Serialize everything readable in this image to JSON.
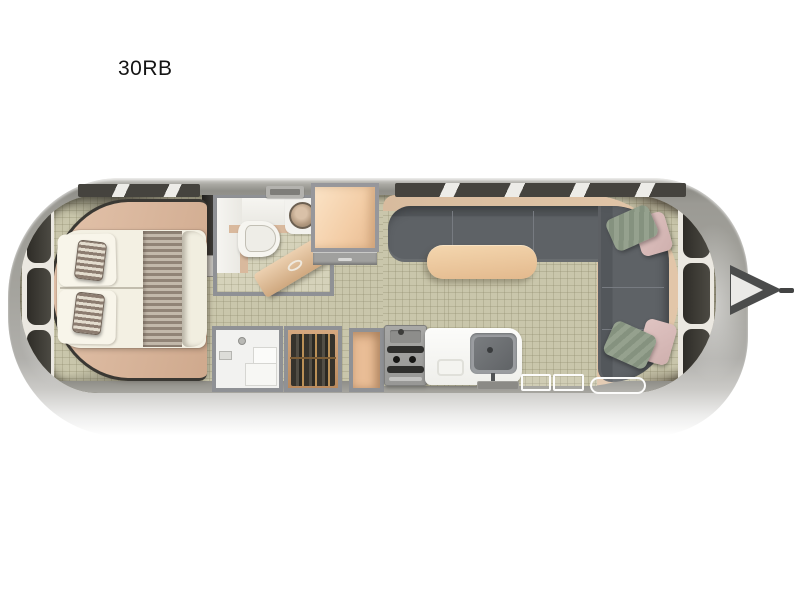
{
  "page": {
    "background_color": "#ffffff"
  },
  "title": {
    "label": "30RB"
  },
  "floorplan": {
    "type": "travel-trailer-floorplan",
    "orientation": "hitch-right",
    "colors": {
      "shell": "#a5a49e",
      "floor": "#c9c6ab",
      "interior_walls": "#8f9195",
      "wood_accent": "#e8c49e",
      "sofa": "#5d6166",
      "mattress": "#f3f0e3",
      "pillow_stripe": "#8c7c70",
      "throw_pillow_green": "#8c9a87",
      "throw_pillow_pink": "#d9bdbb",
      "window_glass": "#3a372f",
      "window_frame": "#ebe8e1",
      "hitch": "#4b4c4c"
    },
    "rooms": {
      "bedroom": {
        "position": "rear-left",
        "fixtures": [
          "queen-bed",
          "bed-platform",
          "striped-pillow",
          "striped-pillow",
          "striped-bed-runner",
          "foot-bolster",
          "wardrobe-partition"
        ]
      },
      "bathroom": {
        "position": "mid-top",
        "fixtures": [
          "vanity-counter",
          "round-sink",
          "toilet",
          "roof-vent",
          "swing-door"
        ]
      },
      "storage": {
        "position": "mid-bottom",
        "fixtures": [
          "shower-with-bench",
          "hanging-closet",
          "open-cabinet"
        ]
      },
      "galley": {
        "position": "mid-bottom-right",
        "fixtures": [
          "two-burner-stove",
          "kitchen-counter",
          "single-basin-sink",
          "faucet",
          "cutting-board"
        ]
      },
      "lounge": {
        "position": "front-right",
        "fixtures": [
          "u-shaped-sofa",
          "dinette-table",
          "green-throw-pillow",
          "pink-throw-pillow",
          "green-throw-pillow",
          "pink-throw-pillow",
          "front-wardrobe",
          "wardrobe-drawer"
        ]
      },
      "exterior": {
        "fixtures": [
          "entry-step",
          "entry-step",
          "entry-pad",
          "utility-tray",
          "a-frame-hitch",
          "hitch-coupler-bar",
          "rear-windows",
          "front-windows",
          "side-window-bands"
        ]
      }
    }
  }
}
